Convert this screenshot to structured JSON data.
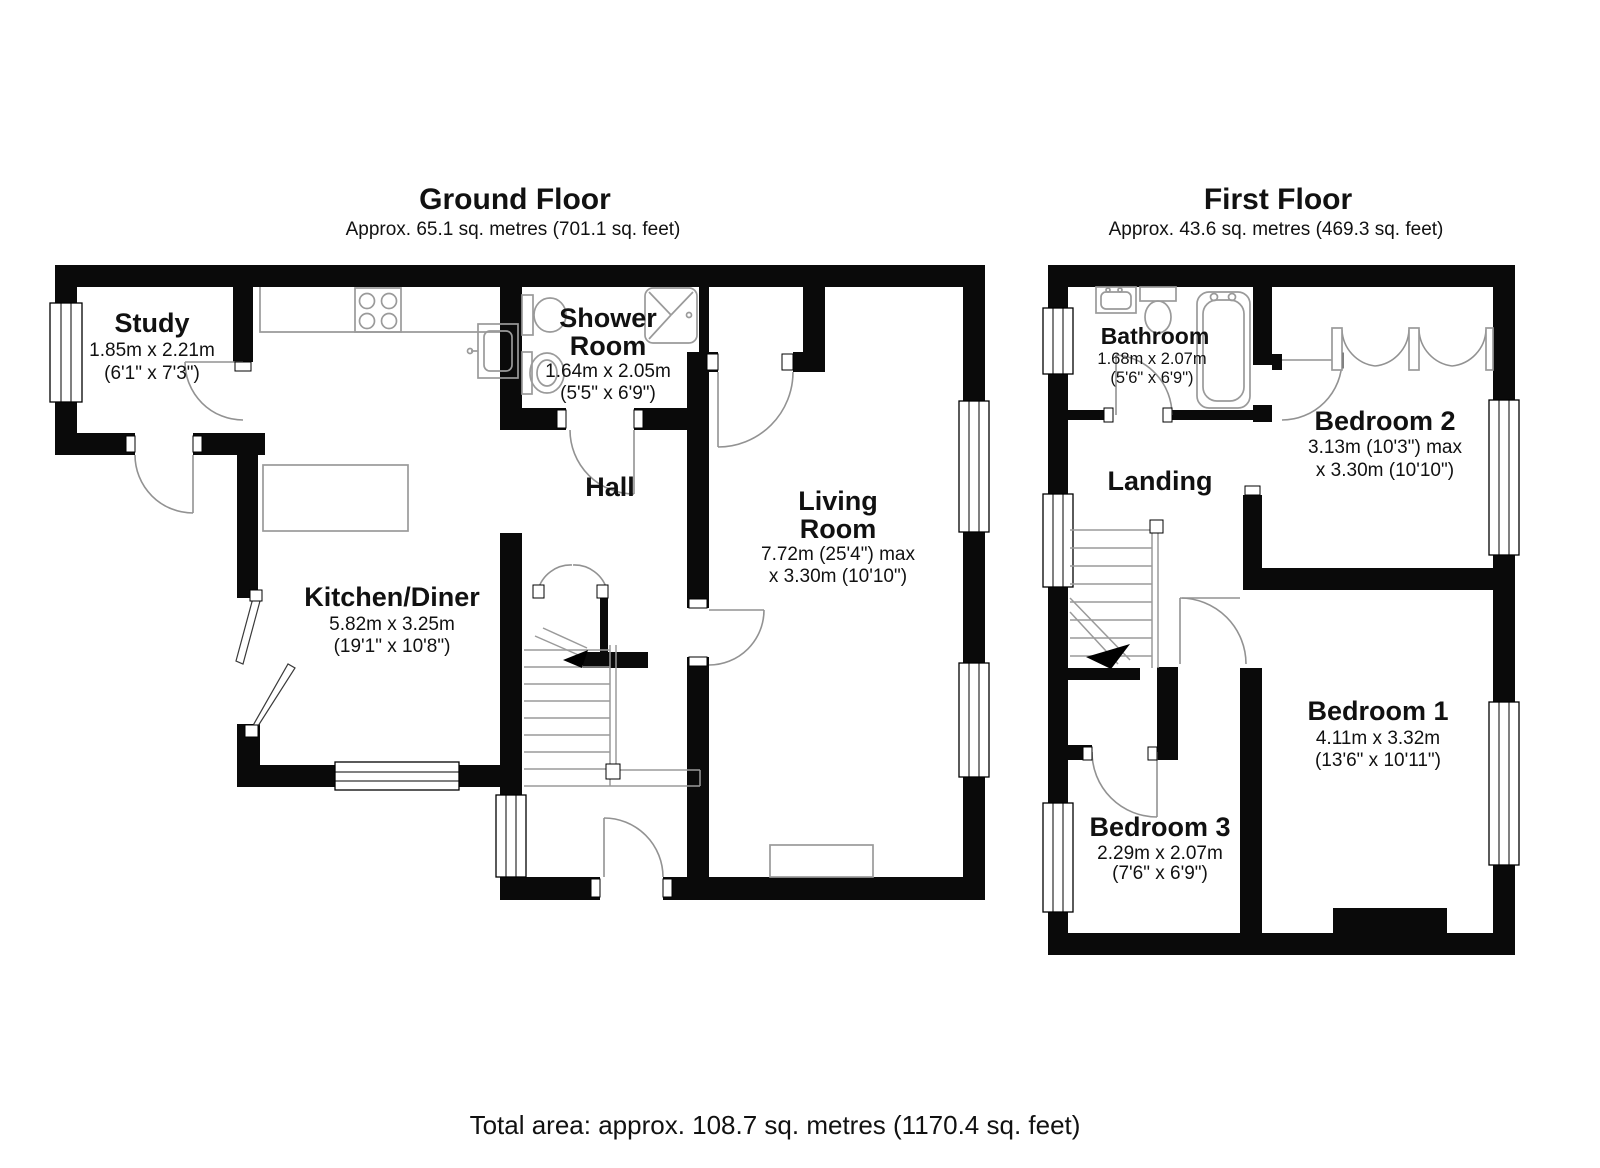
{
  "ground_floor": {
    "title": "Ground Floor",
    "subtitle": "Approx. 65.1 sq. metres (701.1 sq. feet)",
    "rooms": {
      "study": {
        "name": "Study",
        "metric": "1.85m x 2.21m",
        "imperial": "(6'1\" x 7'3\")"
      },
      "shower_room": {
        "name1": "Shower",
        "name2": "Room",
        "metric": "1.64m x 2.05m",
        "imperial": "(5'5\" x 6'9\")"
      },
      "hall": {
        "name": "Hall"
      },
      "kitchen_diner": {
        "name": "Kitchen/Diner",
        "metric": "5.82m x 3.25m",
        "imperial": "(19'1\" x 10'8\")"
      },
      "living_room": {
        "name1": "Living",
        "name2": "Room",
        "metric": "7.72m (25'4\") max",
        "metric2": "x 3.30m (10'10\")"
      }
    }
  },
  "first_floor": {
    "title": "First Floor",
    "subtitle": "Approx. 43.6 sq. metres (469.3 sq. feet)",
    "rooms": {
      "bathroom": {
        "name": "Bathroom",
        "metric": "1.68m x 2.07m",
        "imperial": "(5'6\" x 6'9\")"
      },
      "bedroom2": {
        "name": "Bedroom 2",
        "metric": "3.13m (10'3\") max",
        "metric2": "x 3.30m (10'10\")"
      },
      "landing": {
        "name": "Landing"
      },
      "bedroom1": {
        "name": "Bedroom 1",
        "metric": "4.11m x 3.32m",
        "imperial": "(13'6\" x 10'11\")"
      },
      "bedroom3": {
        "name": "Bedroom 3",
        "metric": "2.29m x 2.07m",
        "imperial": "(7'6\" x 6'9\")"
      }
    }
  },
  "footer": {
    "total_area": "Total area: approx. 108.7 sq. metres (1170.4 sq. feet)"
  }
}
